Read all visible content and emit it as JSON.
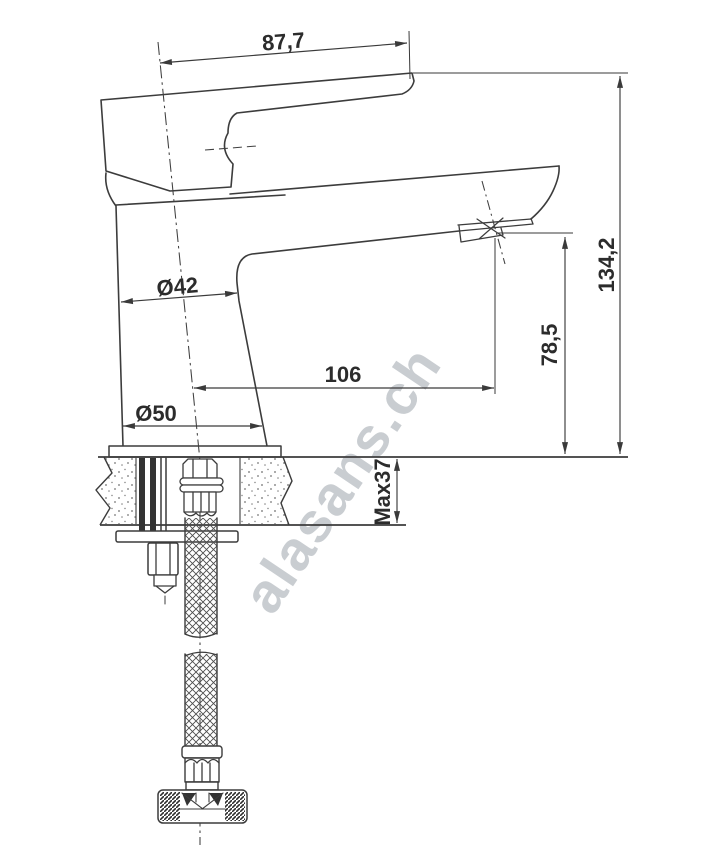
{
  "drawing": {
    "kind": "technical-dimension-drawing",
    "line_color": "#3a3a3a",
    "text_color": "#2c2c2c",
    "watermark": {
      "text": "alasans.ch",
      "color": "#c9cdd1"
    },
    "dimensions": {
      "handle_reach": "87,7",
      "body_diameter": "Ø42",
      "base_diameter": "Ø50",
      "spout_reach": "106",
      "spout_height": "78,5",
      "total_height": "134,2",
      "max_deck_thickness": "Max37"
    }
  }
}
